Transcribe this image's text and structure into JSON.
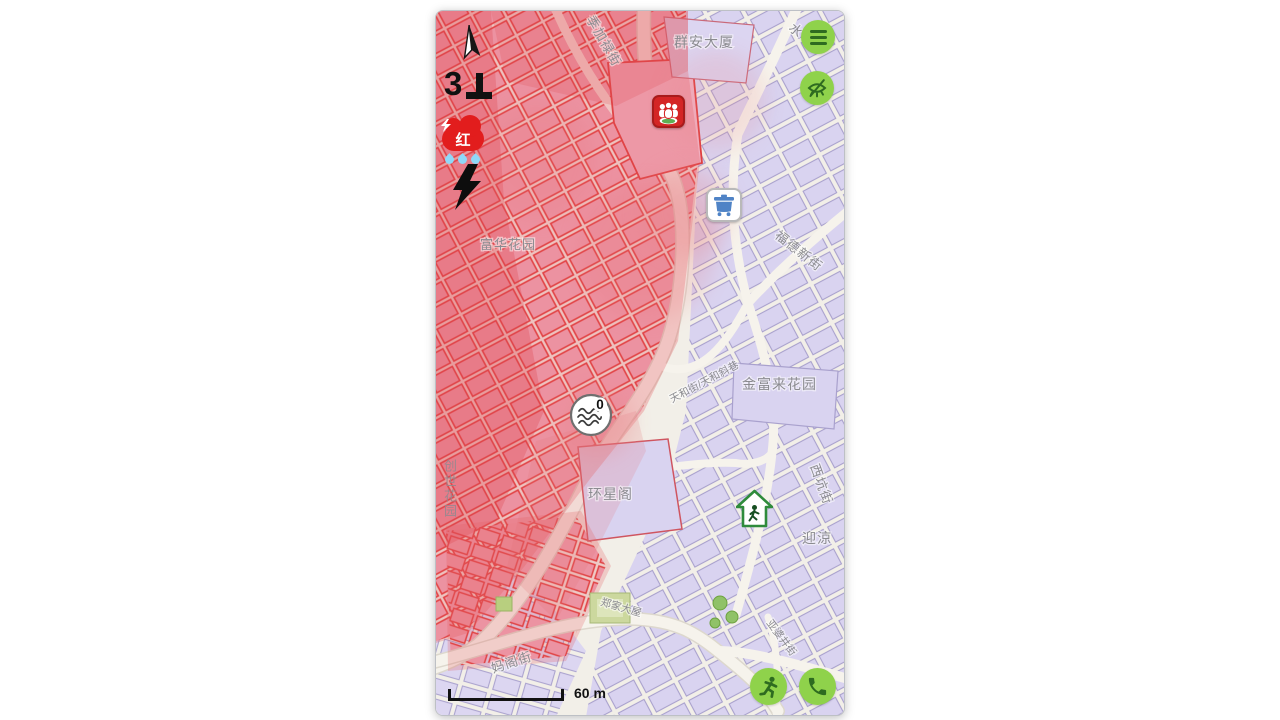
{
  "warnings": {
    "typhoon_signal_number": "3",
    "rainstorm_signal_text": "红",
    "icons": {
      "compass": "north-arrow",
      "typhoon": "signal-3-inverted-t",
      "rainstorm": "red-rain-cloud-with-drops",
      "thunderstorm": "black-lightning-bolt"
    }
  },
  "controls": {
    "menu_icon": "hamburger-menu",
    "visibility_icon": "eye-off",
    "evacuate_icon": "running-person",
    "call_icon": "phone-handset"
  },
  "markers": {
    "assembly_point_icon": "people-group",
    "collection_point_icon": "blue-container",
    "shelter_icon": "house-with-walking-person",
    "flood_sensor_icon": "water-waves",
    "flood_sensor_value": "0"
  },
  "map": {
    "scale_label": "60 m",
    "labels": {
      "jijialu_street": "季加禄街",
      "qunan_building": "群安大厦",
      "water_partial": "水",
      "fuhua_garden": "富华花园",
      "fude_new_street": "福德新街",
      "tianhe_street": "天和街/天和斜巷",
      "jinfulai_garden": "金富来花园",
      "huanxing_court": "环星阁",
      "xikeng_street": "西坑街",
      "yingliang": "迎涼",
      "zhengjia_mansion": "郑家大屋",
      "mage_street": "妈阁街",
      "yapojing_street": "亚婆井街",
      "chuangshi_garden": "创世花园"
    }
  },
  "colors": {
    "accent_green": "#8fd24b",
    "glyph_green": "#2e6b20",
    "warning_red": "#e21d1d",
    "flood_overlay": "#e35a60",
    "flooded_building_fill": "#f0abbd",
    "flooded_building_stroke": "#e03a3a",
    "building_fill": "#d9d3f0",
    "building_stroke": "#a9a1cd",
    "street": "#f5f2ea"
  }
}
